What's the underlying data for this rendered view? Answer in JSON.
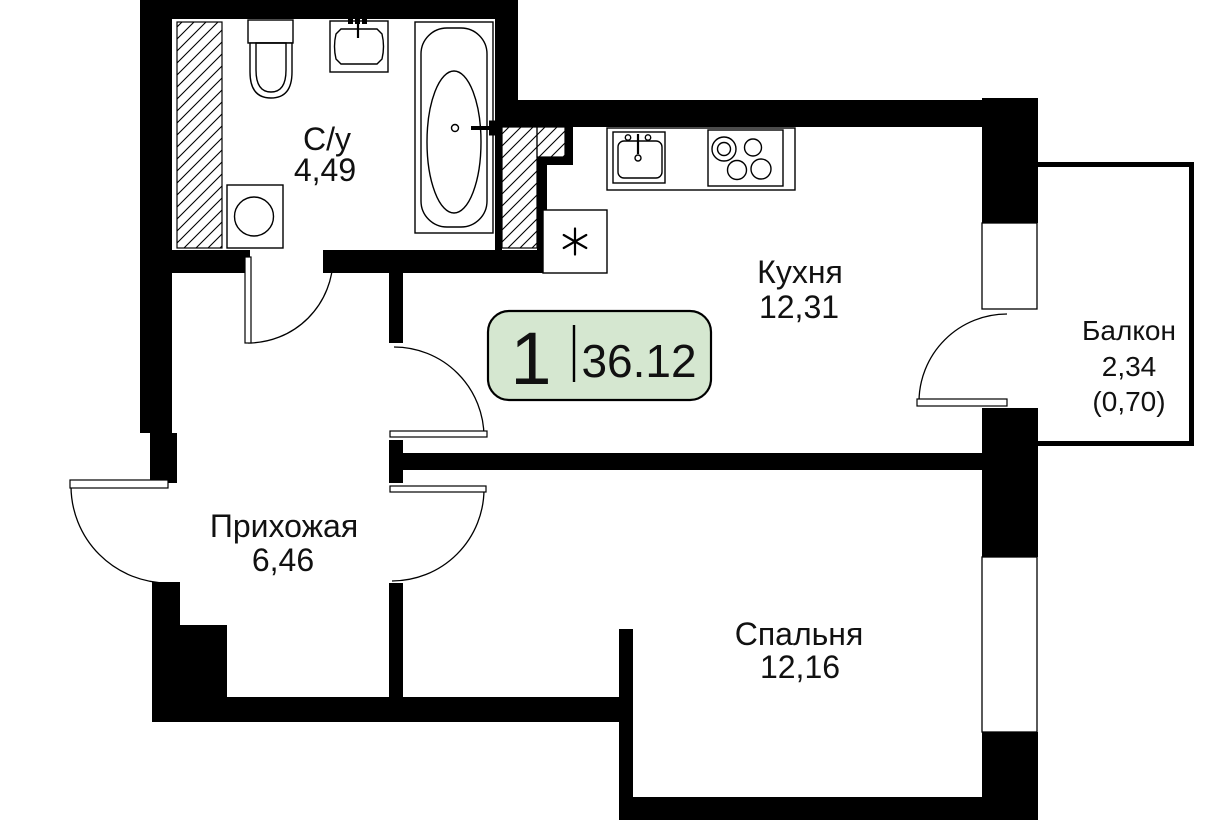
{
  "badge": {
    "room_count": "1",
    "total_area": "36.12",
    "fill": "#d5e7d0"
  },
  "rooms": {
    "bathroom": {
      "label": "С/у",
      "area": "4,49"
    },
    "kitchen": {
      "label": "Кухня",
      "area": "12,31"
    },
    "hallway": {
      "label": "Прихожая",
      "area": "6,46"
    },
    "bedroom": {
      "label": "Спальня",
      "area": "12,16"
    },
    "balcony": {
      "label": "Балкон",
      "area": "2,34",
      "area_coeff": "(0,70)"
    }
  },
  "colors": {
    "wall": "#000000",
    "badge_fill": "#d5e7d0",
    "text": "#111111"
  },
  "icons": {
    "appliance_marker": "six-spoke-asterisk",
    "fixtures": [
      "toilet",
      "washbasin",
      "bathtub",
      "washing-machine",
      "kitchen-sink",
      "stove",
      "ventilation-shaft-hatch"
    ]
  }
}
